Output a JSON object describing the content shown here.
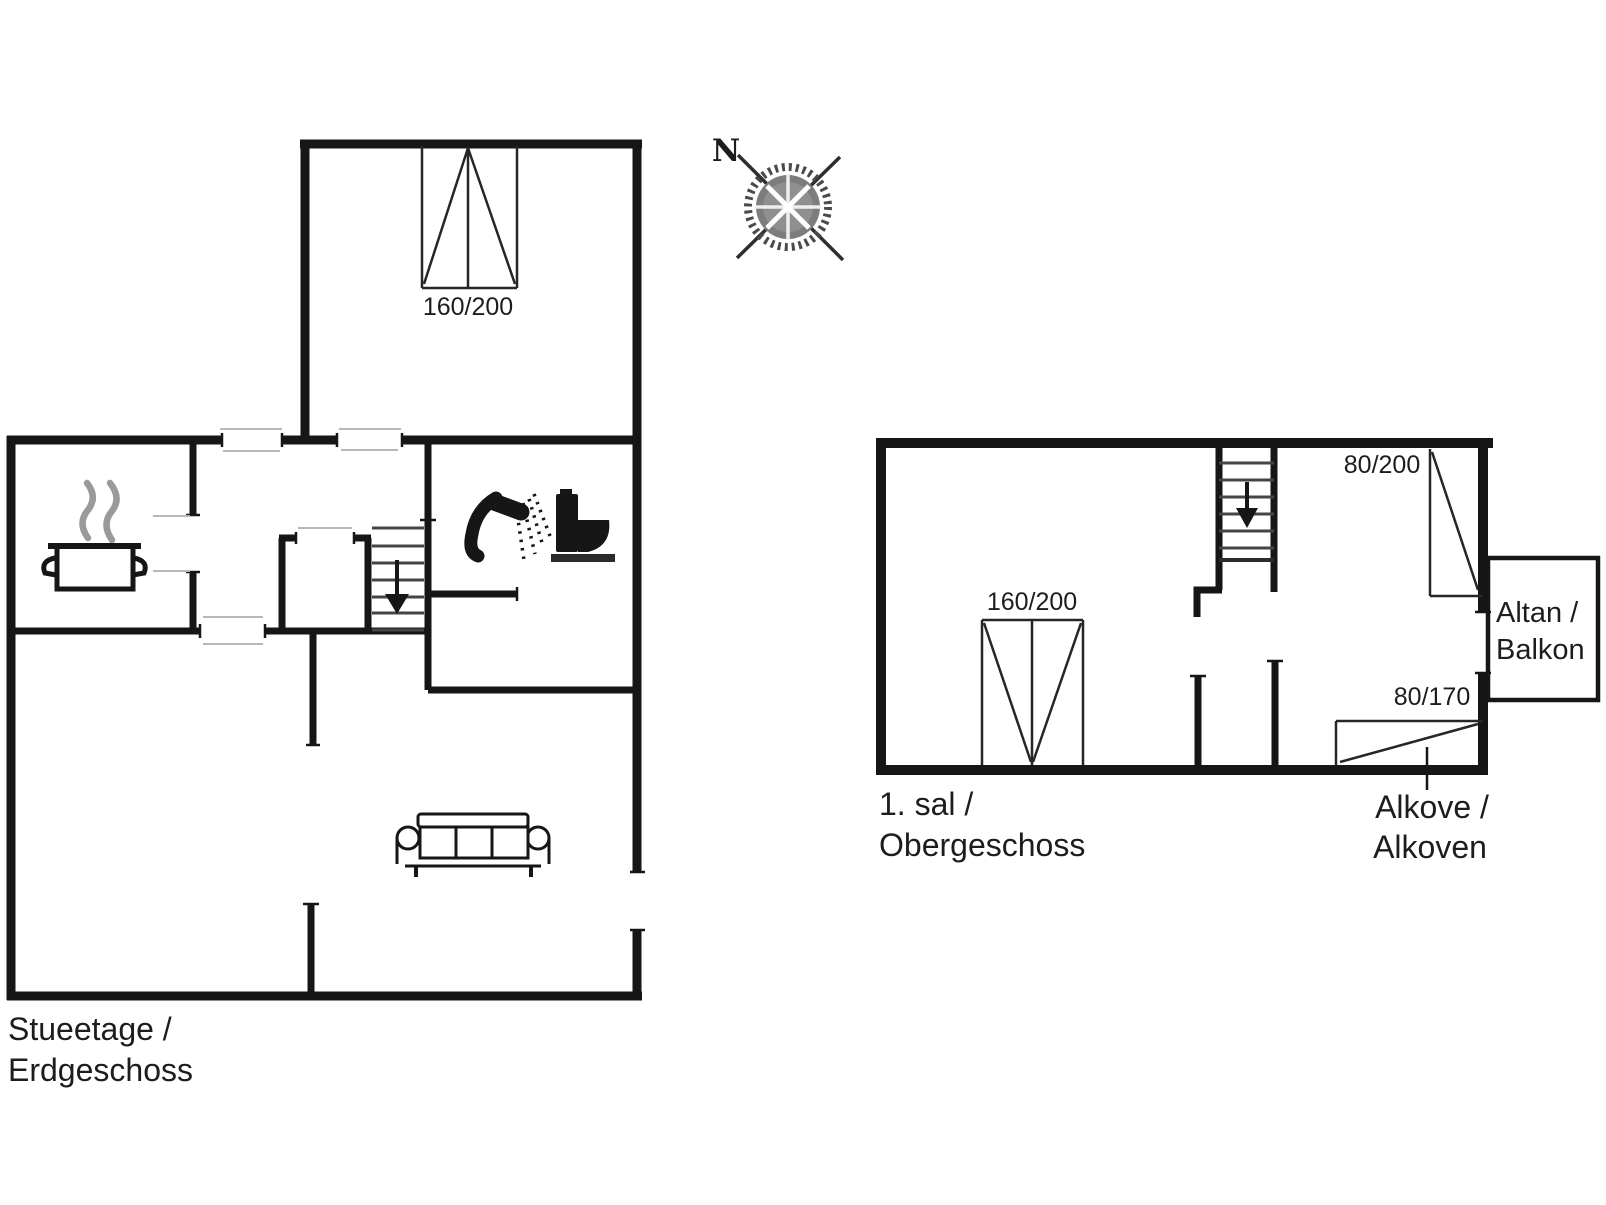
{
  "compass": {
    "north_label": "N"
  },
  "ground_floor": {
    "name_line1": "Stueetage /",
    "name_line2": "Erdgeschoss",
    "window_label": "160/200",
    "icons": {
      "kitchen": "cooking-pot-icon",
      "bathroom": [
        "shower-icon",
        "toilet-icon"
      ],
      "living_room": "sofa-icon",
      "stairs": "stairs-down-arrow-icon"
    }
  },
  "first_floor": {
    "name_line1": "1. sal /",
    "name_line2": "Obergeschoss",
    "window_label_left": "160/200",
    "window_label_right": "80/200",
    "window_label_alcove": "80/170",
    "balcony_line1": "Altan /",
    "balcony_line2": "Balkon",
    "alcove_line1": "Alkove /",
    "alcove_line2": "Alkoven",
    "icons": {
      "stairs": "stairs-down-arrow-icon"
    }
  }
}
